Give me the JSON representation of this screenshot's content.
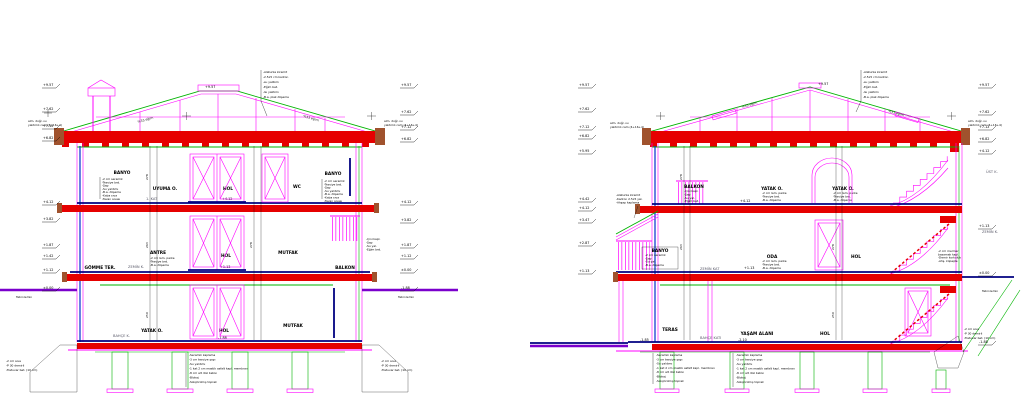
{
  "colors": {
    "magenta": "#FF00FF",
    "red": "#E60000",
    "brown": "#A0522D",
    "green": "#00B400",
    "blue": "#0033CC",
    "navy": "#000080",
    "purple": "#7A00CC",
    "hatch_gray": "#9A9A9A"
  },
  "L": {
    "floors": {
      "top": "1. KAT",
      "mid": "ZEMİN K.",
      "bottom": "BAHÇE K."
    },
    "rooms": {
      "top": [
        "BANYO",
        "UYUMA O.",
        "HOL",
        "WC",
        "BANYO"
      ],
      "mid": [
        "GÖMME TER.",
        "ANTRE",
        "HOL",
        "MUTFAK",
        "BALKON"
      ],
      "bottom": [
        "YATAK O.",
        "HOL",
        "MUTFAK"
      ]
    },
    "ev": [
      "+9.57",
      "+7.62",
      "+7.12",
      "+6.82",
      "+4.12",
      "+3.82",
      "+1.87",
      "+1.42",
      "+1.12",
      "±0.00"
    ],
    "evR": [
      "+9.57",
      "+7.62",
      "+7.12",
      "+6.82",
      "+4.12",
      "+3.82",
      "+1.87",
      "+1.12",
      "±0.00",
      "-1.88"
    ],
    "ridge": "+9.57",
    "slope": "%33 eğim",
    "inline": {
      "top": "+4.12",
      "mid": "+1.13",
      "bottom": "-1.88"
    }
  },
  "R": {
    "floors": {
      "mid": "ZEMİN KAT",
      "bottom": "BAHÇE KATI"
    },
    "margin": {
      "top": "ÜST K.",
      "mid": "ZEMİN K."
    },
    "rooms": {
      "top": [
        "BALKON",
        "YATAK O.",
        "YATAK O."
      ],
      "mid": [
        "BANYO",
        "ODA",
        "HOL"
      ],
      "bottom": [
        "TERAS",
        "YAŞAM ALANI",
        "HOL"
      ]
    },
    "ev": [
      "+9.57",
      "+7.62",
      "+7.12",
      "+6.82",
      "+5.95",
      "+4.42",
      "+4.12",
      "+3.47",
      "+2.87",
      "+1.13"
    ],
    "evR": [
      "+9.57",
      "+7.62",
      "+7.12",
      "+6.82",
      "+4.12",
      "+1.13",
      "±0.00",
      "-1.88"
    ],
    "ridge": "+9.57",
    "slope": "%33 eğim",
    "inline": {
      "top": "+4.12",
      "mid": "+1.13",
      "teras": "-1.85",
      "yasam": "-2.10"
    }
  },
  "notes": {
    "roof": [
      "-Alaturka kiremit",
      "-2.5x5 cm kadron",
      "-su yalıtımı",
      "-Eğim bet.",
      "-Isı yalıtımı",
      "-B.a. plak döşeme"
    ],
    "wet": [
      "-2 cm seramik",
      "-Tesviye bet.",
      "-Şap",
      "-Su yalıtımı",
      "-B.a. döşeme",
      "-Kaba sıva",
      "-Tavan sıvası"
    ],
    "banyoS": [
      "-2 cm seramik",
      "-Şap",
      "-Su yal.",
      "-B.a. döşeme"
    ],
    "oda": [
      "-2 cm lam. parke",
      "-Tesviye bet.",
      "-B.a. döşeme"
    ],
    "balkon": [
      "-Çini kapl.",
      "-Şap",
      "-Su yal.",
      "-Eğim bet."
    ],
    "grade": [
      "-Seramik kaplama",
      "-3 cm tesviye şapı",
      "-Su yalıtımı",
      "-1 kat 2 cm mastik asfalt kapl. membran",
      "-8 cm alt düz beton",
      "-Blokaj",
      "-Sıkıştırılmış toprak"
    ],
    "footing": [
      "-2 cm sıva",
      "-P 30 demirli",
      "-Tretuvar bet. (10 cm)"
    ],
    "eave_glass": [
      "alm. doğr. ısı",
      "yalıtımlı cam (4+16+4)"
    ],
    "shed": [
      "-Alaturka kiremit",
      "-Kadron 2.5x5 yal.",
      "-Ahşap kaplama"
    ],
    "stair": [
      "-2 cm mermer",
      "basamak kapl.",
      "-Demir korkuluk",
      "-Ahş. küpeşte"
    ],
    "ground": "Tabii zemin"
  },
  "dims": [
    "278",
    "263",
    "250"
  ]
}
